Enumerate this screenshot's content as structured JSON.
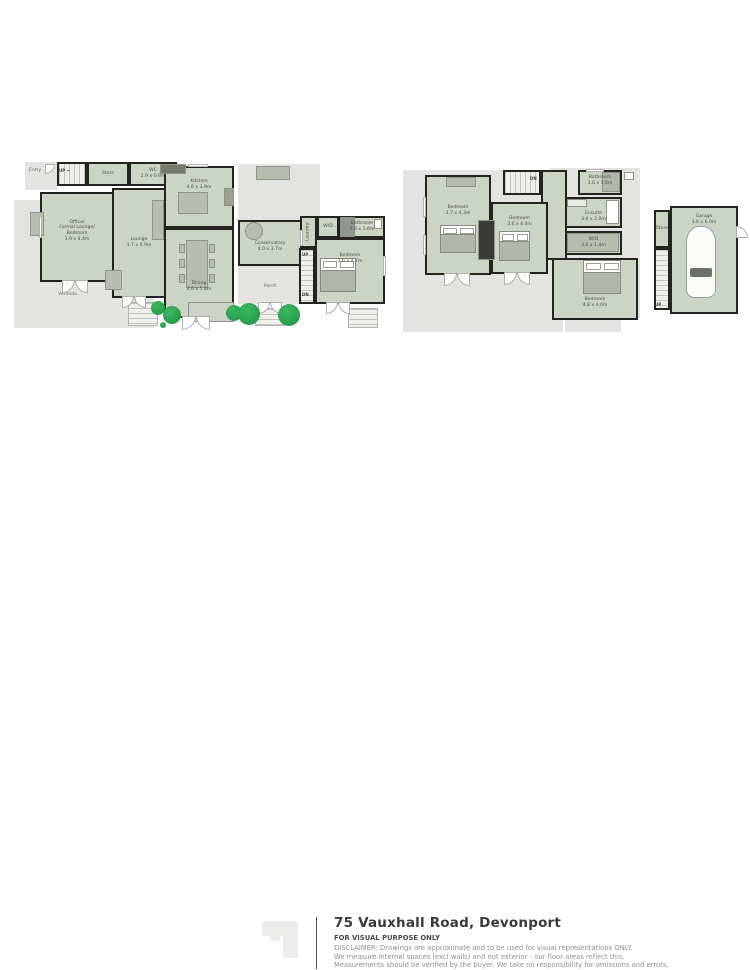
{
  "footer": {
    "title": "75 Vauxhall Road, Devonport",
    "purpose": "FOR VISUAL PURPOSE ONLY",
    "disclaimer_lines": [
      "DISCLAIMER:  Drawings are approximate and to be used for visual representations ONLY.",
      "We measure internal spaces (excl walls) and not exterior - our floor areas reflect this.",
      "Measurements should be verified by the buyer. We take no responsibility for omissions and errors."
    ]
  },
  "colors": {
    "room_fill": "#ccd4c5",
    "deck_fill": "#e3e3e1",
    "wall": "#23231f",
    "furniture": "#b7bdb0",
    "tree": "#28a34c",
    "label_text": "#4c514a"
  },
  "plans": [
    {
      "name": "ground-floor-plan",
      "box": [
        12,
        156,
        382,
        184
      ],
      "zones": [
        {
          "name": "entry-area",
          "box": [
            13,
            6,
            32,
            28
          ],
          "label": "Entry",
          "labelPos": [
            4,
            6
          ]
        },
        {
          "name": "deck-area",
          "box": [
            226,
            8,
            82,
            56
          ]
        },
        {
          "name": "veranda-left",
          "box": [
            2,
            44,
            34,
            96
          ]
        },
        {
          "name": "veranda-bottom",
          "box": [
            2,
            126,
            140,
            46
          ],
          "label": "Veranda",
          "labelPos": [
            44,
            10
          ]
        },
        {
          "name": "porch-area",
          "box": [
            226,
            110,
            64,
            38
          ],
          "label": "Porch",
          "labelPos": [
            26,
            18
          ]
        }
      ],
      "rooms": [
        {
          "id": "stair-lobby",
          "box": [
            45,
            6,
            30,
            24
          ],
          "stairs": "v",
          "lines": []
        },
        {
          "id": "store",
          "box": [
            75,
            6,
            42,
            24
          ],
          "lines": [
            "Store"
          ]
        },
        {
          "id": "wc",
          "box": [
            117,
            6,
            48,
            24
          ],
          "lines": [
            "WC",
            "2.9 x 0.9m"
          ]
        },
        {
          "id": "office-formal-lounge",
          "box": [
            28,
            36,
            74,
            90
          ],
          "lines": [
            "Office/",
            "Formal Lounge/",
            "Bedroom",
            "3.9 x 4.4m"
          ],
          "labelDy": -6
        },
        {
          "id": "lounge",
          "box": [
            100,
            32,
            54,
            110
          ],
          "lines": [
            "Lounge",
            "3.7 x 4.9m"
          ]
        },
        {
          "id": "kitchen",
          "box": [
            152,
            10,
            70,
            62
          ],
          "lines": [
            "Kitchen",
            "4.6 x 3.9m"
          ],
          "labelDy": -12
        },
        {
          "id": "dining",
          "box": [
            152,
            72,
            70,
            90
          ],
          "lines": [
            "Dining",
            "4.6 x 5.8m"
          ],
          "labelDy": 14
        },
        {
          "id": "conservatory",
          "box": [
            226,
            64,
            64,
            46
          ],
          "lines": [
            "Conservatory",
            "4.0 x 3.7m"
          ],
          "labelDy": 4
        },
        {
          "id": "laundry",
          "box": [
            288,
            60,
            17,
            32
          ],
          "lines": [
            "Laundry"
          ],
          "vert": true
        },
        {
          "id": "wd",
          "box": [
            305,
            60,
            22,
            22
          ],
          "lines": [
            "W/D"
          ]
        },
        {
          "id": "bathroom",
          "box": [
            327,
            60,
            46,
            22
          ],
          "lines": [
            "Bathroom",
            "2.6 x 1.6m"
          ]
        },
        {
          "id": "bedroom",
          "box": [
            303,
            82,
            70,
            66
          ],
          "lines": [
            "Bedroom",
            "3.6 x 4.7m"
          ],
          "labelDy": -12
        },
        {
          "id": "stairs-right",
          "box": [
            287,
            92,
            16,
            56
          ],
          "stairs": "h",
          "lines": []
        }
      ],
      "items": [
        {
          "t": "rect",
          "box": [
            148,
            8,
            26,
            10
          ],
          "fill": "#77796f"
        },
        {
          "t": "rect",
          "box": [
            166,
            36,
            30,
            22
          ]
        },
        {
          "t": "rect",
          "box": [
            212,
            32,
            10,
            18
          ],
          "fill": "#9aa094"
        },
        {
          "t": "dtable",
          "box": [
            174,
            84,
            22,
            48
          ]
        },
        {
          "t": "rect",
          "box": [
            140,
            44,
            12,
            40
          ]
        },
        {
          "t": "rect",
          "box": [
            18,
            56,
            14,
            24
          ]
        },
        {
          "t": "rect",
          "box": [
            93,
            114,
            17,
            20
          ]
        },
        {
          "t": "rect",
          "box": [
            244,
            10,
            34,
            14
          ]
        },
        {
          "t": "circle",
          "box": [
            233,
            66,
            18,
            18
          ]
        },
        {
          "t": "rect",
          "box": [
            328,
            61,
            15,
            20
          ],
          "fill": "#8f968f"
        },
        {
          "t": "rect",
          "box": [
            362,
            63,
            8,
            10
          ],
          "fill": "#ffffff"
        },
        {
          "t": "bed",
          "box": [
            308,
            102,
            36,
            34
          ]
        },
        {
          "t": "steps",
          "box": [
            116,
            146,
            30,
            24
          ]
        },
        {
          "t": "steps",
          "box": [
            243,
            152,
            30,
            18
          ]
        },
        {
          "t": "steps",
          "box": [
            336,
            152,
            30,
            20
          ]
        },
        {
          "t": "rect",
          "box": [
            176,
            146,
            46,
            20
          ],
          "fill": "#cfd2ca"
        },
        {
          "t": "ddoor",
          "x": 50,
          "y": 124,
          "w": 26
        },
        {
          "t": "ddoor",
          "x": 110,
          "y": 140,
          "w": 24
        },
        {
          "t": "ddoor",
          "x": 170,
          "y": 160,
          "w": 28
        },
        {
          "t": "ddoor",
          "x": 246,
          "y": 146,
          "w": 24
        },
        {
          "t": "ddoor",
          "x": 314,
          "y": 146,
          "w": 24
        },
        {
          "t": "door",
          "box": [
            33,
            8,
            10,
            10
          ],
          "rad": "br"
        },
        {
          "t": "win",
          "box": [
            27,
            60,
            3,
            22
          ]
        },
        {
          "t": "win",
          "box": [
            176,
            8,
            20,
            3
          ]
        },
        {
          "t": "win",
          "box": [
            288,
            74,
            3,
            16
          ]
        },
        {
          "t": "win",
          "box": [
            371,
            100,
            3,
            20
          ]
        },
        {
          "t": "tree",
          "cx": 146,
          "cy": 152,
          "r": 7
        },
        {
          "t": "tree",
          "cx": 160,
          "cy": 159,
          "r": 9
        },
        {
          "t": "tree",
          "cx": 151,
          "cy": 169,
          "r": 3
        },
        {
          "t": "tree",
          "cx": 222,
          "cy": 157,
          "r": 8
        },
        {
          "t": "tree",
          "cx": 237,
          "cy": 158,
          "r": 11
        },
        {
          "t": "tree",
          "cx": 277,
          "cy": 159,
          "r": 11
        },
        {
          "t": "label",
          "x": 47,
          "y": 12,
          "text": "UP →"
        },
        {
          "t": "label",
          "x": 290,
          "y": 96,
          "text": "UP"
        },
        {
          "t": "label",
          "x": 290,
          "y": 136,
          "text": "DN"
        }
      ]
    },
    {
      "name": "first-floor-plan",
      "box": [
        400,
        163,
        244,
        172
      ],
      "zones": [
        {
          "name": "roof-deck-left",
          "box": [
            3,
            7,
            160,
            162
          ]
        },
        {
          "name": "roof-deck-right",
          "box": [
            150,
            5,
            90,
            150
          ]
        },
        {
          "name": "porch-below-bedroom",
          "box": [
            165,
            157,
            56,
            12
          ]
        }
      ],
      "rooms": [
        {
          "id": "bedroom-1",
          "box": [
            25,
            12,
            66,
            100
          ],
          "lines": [
            "Bedroom",
            "3.7 x 4.3m"
          ],
          "labelDy": -14
        },
        {
          "id": "stairs-top",
          "box": [
            103,
            7,
            38,
            25
          ],
          "stairs": "v",
          "lines": []
        },
        {
          "id": "landing",
          "box": [
            141,
            7,
            26,
            90
          ],
          "lines": []
        },
        {
          "id": "bedroom-2",
          "box": [
            91,
            39,
            57,
            72
          ],
          "lines": [
            "Bedroom",
            "3.6 x 4.4m"
          ],
          "labelDy": -16
        },
        {
          "id": "bathroom-up",
          "box": [
            178,
            7,
            44,
            25
          ],
          "lines": [
            "Bathroom",
            "3.6 x 1.4m"
          ],
          "labelDy": -2
        },
        {
          "id": "ensuite",
          "box": [
            165,
            34,
            57,
            31
          ],
          "lines": [
            "Ensuite",
            "3.6 x 2.0m"
          ],
          "labelDy": 4
        },
        {
          "id": "wd-up",
          "box": [
            165,
            68,
            57,
            24
          ],
          "lines": [
            "W/D",
            "3.6 x 1.4m"
          ]
        },
        {
          "id": "bedroom-3",
          "box": [
            152,
            95,
            86,
            62
          ],
          "lines": [
            "Bedroom",
            "4.8 x 4.0m"
          ],
          "labelDy": 14
        }
      ],
      "items": [
        {
          "t": "rect",
          "box": [
            78,
            57,
            17,
            40
          ],
          "fill": "#3a3a38"
        },
        {
          "t": "rect",
          "box": [
            46,
            14,
            30,
            10
          ]
        },
        {
          "t": "bed",
          "box": [
            40,
            62,
            36,
            28
          ]
        },
        {
          "t": "bed",
          "box": [
            99,
            68,
            31,
            30
          ]
        },
        {
          "t": "bed",
          "box": [
            183,
            97,
            38,
            34
          ]
        },
        {
          "t": "rect",
          "box": [
            167,
            36,
            20,
            8
          ],
          "fill": "#e8eae4"
        },
        {
          "t": "rect",
          "box": [
            206,
            37,
            13,
            24
          ],
          "fill": "#ffffff"
        },
        {
          "t": "rect",
          "box": [
            167,
            70,
            52,
            19
          ]
        },
        {
          "t": "rect",
          "box": [
            202,
            9,
            18,
            20
          ],
          "fill": "#b0b5ab"
        },
        {
          "t": "rect",
          "box": [
            224,
            9,
            10,
            8
          ],
          "fill": "#ffffff"
        },
        {
          "t": "ddoor",
          "x": 44,
          "y": 110,
          "w": 26
        },
        {
          "t": "ddoor",
          "x": 104,
          "y": 109,
          "w": 26
        },
        {
          "t": "win",
          "box": [
            23,
            34,
            3,
            20
          ]
        },
        {
          "t": "win",
          "box": [
            23,
            72,
            3,
            20
          ]
        },
        {
          "t": "win",
          "box": [
            186,
            6,
            18,
            3
          ]
        },
        {
          "t": "label",
          "x": 130,
          "y": 13,
          "text": "DN"
        }
      ]
    },
    {
      "name": "garage-plan",
      "box": [
        650,
        200,
        92,
        124
      ],
      "zones": [],
      "rooms": [
        {
          "id": "garage",
          "box": [
            20,
            6,
            68,
            108
          ],
          "lines": [
            "Garage",
            "3.6 x 6.0m"
          ],
          "labelDy": -40
        },
        {
          "id": "store-garage",
          "box": [
            4,
            10,
            16,
            38
          ],
          "lines": [
            "Store"
          ]
        },
        {
          "id": "stairs-garage",
          "box": [
            4,
            48,
            16,
            62
          ],
          "stairs": "h",
          "lines": []
        }
      ],
      "items": [
        {
          "t": "car",
          "box": [
            36,
            26,
            30,
            72
          ]
        },
        {
          "t": "door",
          "box": [
            86,
            26,
            12,
            12
          ],
          "rad": "tr"
        },
        {
          "t": "label",
          "x": 5,
          "y": 102,
          "text": "UP"
        }
      ]
    }
  ]
}
